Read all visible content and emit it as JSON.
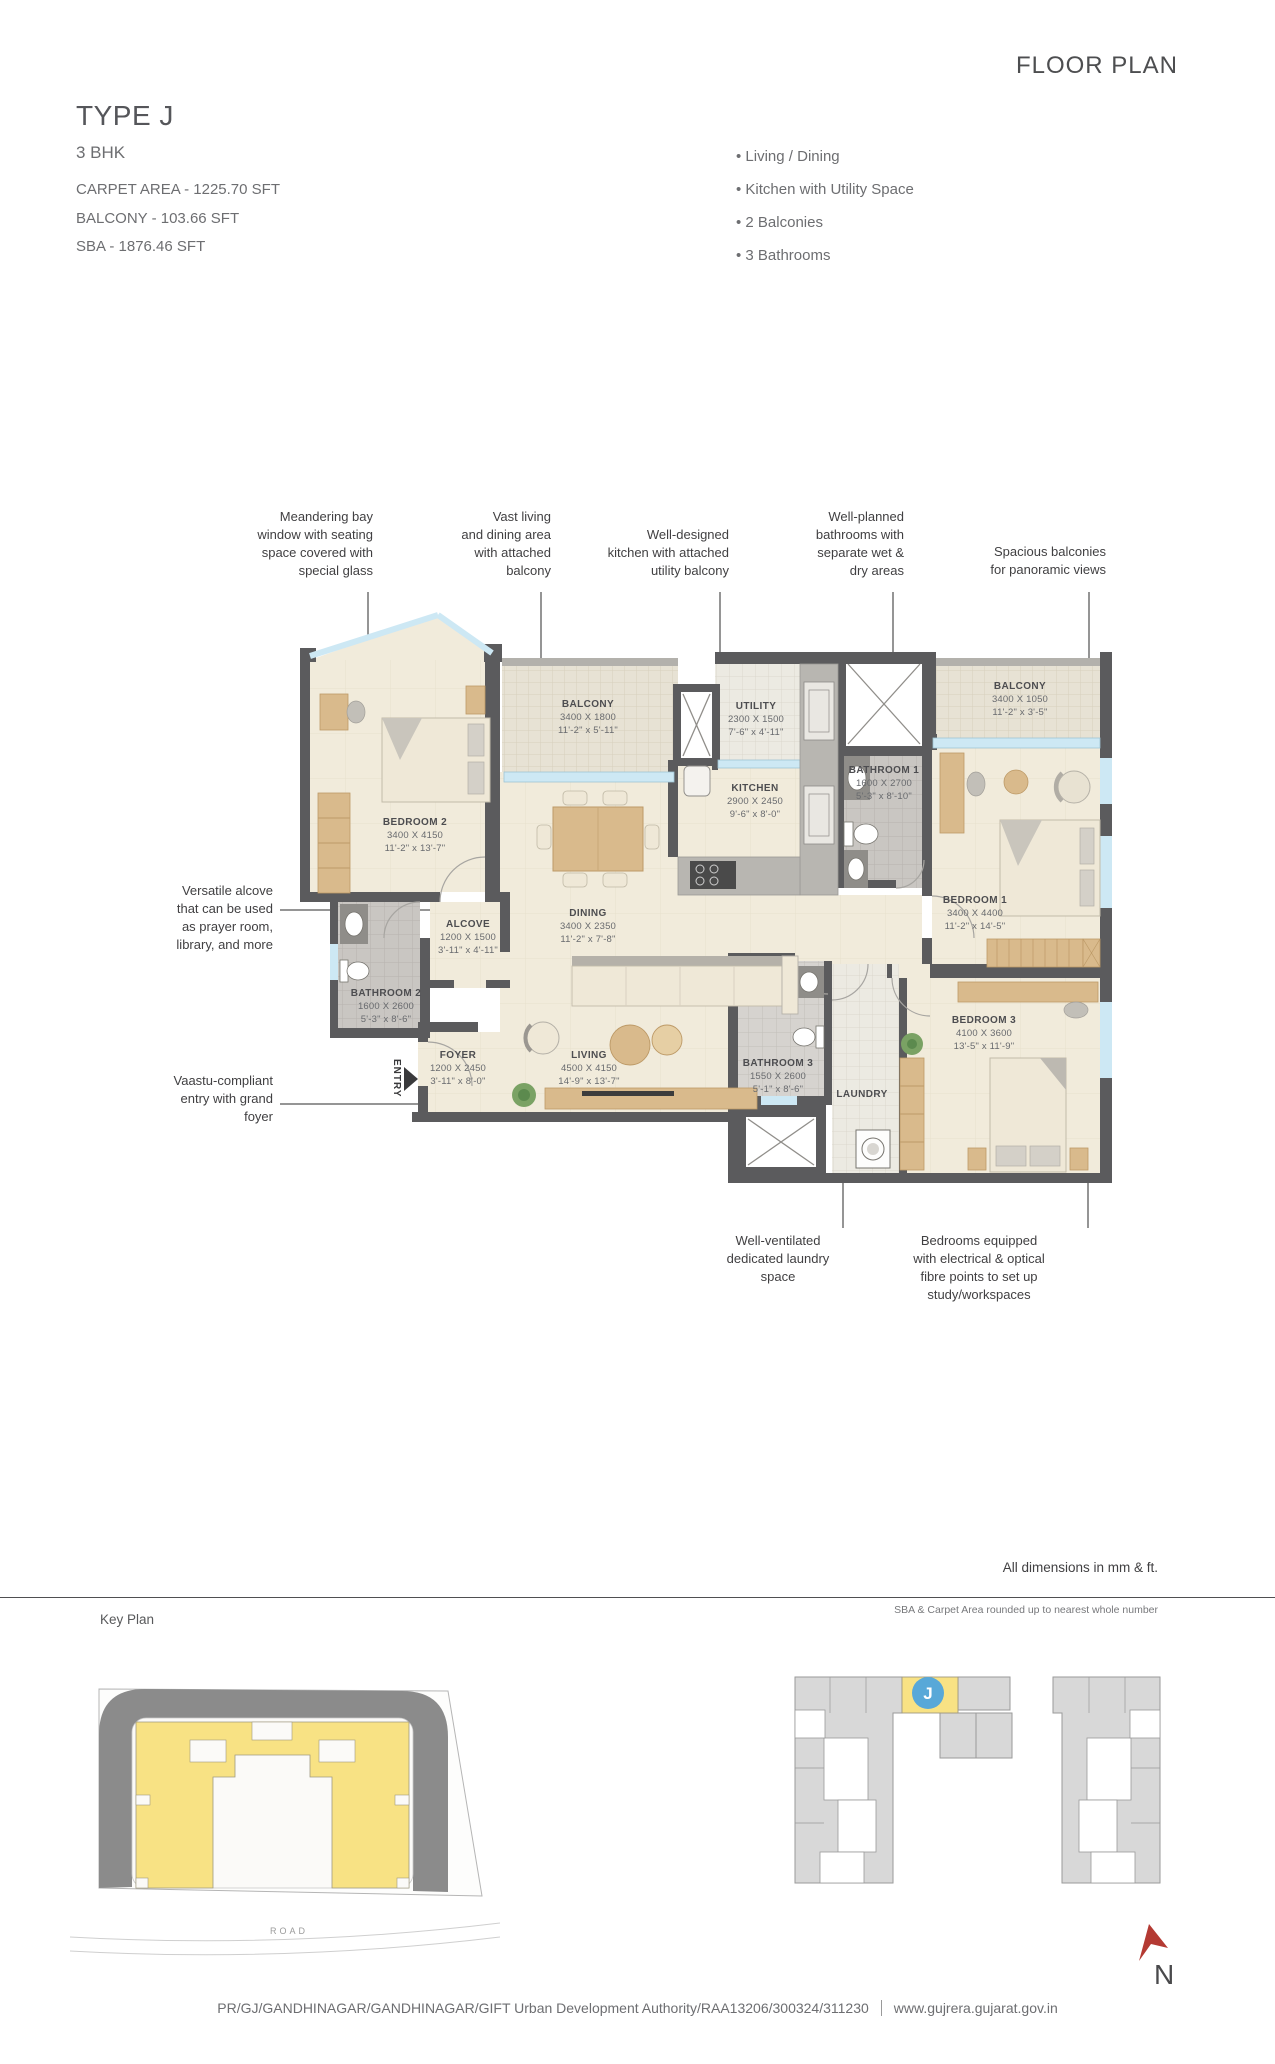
{
  "header": {
    "title": "FLOOR PLAN",
    "unit_type": "TYPE J",
    "bhk": "3 BHK",
    "carpet_area": "CARPET AREA - 1225.70 SFT",
    "balcony_area": "BALCONY - 103.66 SFT",
    "sba_area": "SBA - 1876.46 SFT"
  },
  "features": [
    "Living / Dining",
    "Kitchen with Utility Space",
    "2 Balconies",
    "3 Bathrooms"
  ],
  "annotations": {
    "bay_window": "Meandering bay\nwindow with seating\nspace covered with\nspecial glass",
    "living_dining": "Vast living\nand dining area\nwith attached\nbalcony",
    "kitchen": "Well-designed\nkitchen with attached\nutility balcony",
    "bathrooms": "Well-planned\nbathrooms with\nseparate wet &\ndry areas",
    "balconies": "Spacious balconies\nfor panoramic views",
    "alcove": "Versatile alcove\nthat can be used\nas prayer room,\nlibrary, and more",
    "entry": "Vaastu-compliant\nentry with grand\nfoyer",
    "laundry": "Well-ventilated\ndedicated laundry\nspace",
    "bedrooms": "Bedrooms equipped\nwith electrical & optical\nfibre points to set up\nstudy/workspaces"
  },
  "plan": {
    "entry_label": "ENTRY",
    "rooms": [
      {
        "key": "bedroom2",
        "name": "BEDROOM 2",
        "mm": "3400 X 4150",
        "ft": "11'-2\" x 13'-7\""
      },
      {
        "key": "balcony_l",
        "name": "BALCONY",
        "mm": "3400 X 1800",
        "ft": "11'-2\" x 5'-11\""
      },
      {
        "key": "utility",
        "name": "UTILITY",
        "mm": "2300 X 1500",
        "ft": "7'-6\" x 4'-11\""
      },
      {
        "key": "balcony_r",
        "name": "BALCONY",
        "mm": "3400 X 1050",
        "ft": "11'-2\" x 3'-5\""
      },
      {
        "key": "bathroom1",
        "name": "BATHROOM 1",
        "mm": "1600 X 2700",
        "ft": "5'-3\" x 8'-10\""
      },
      {
        "key": "kitchen",
        "name": "KITCHEN",
        "mm": "2900 X 2450",
        "ft": "9'-6\" x 8'-0\""
      },
      {
        "key": "bedroom1",
        "name": "BEDROOM 1",
        "mm": "3400 X 4400",
        "ft": "11'-2\" x 14'-5\""
      },
      {
        "key": "dining",
        "name": "DINING",
        "mm": "3400 X 2350",
        "ft": "11'-2\" x 7'-8\""
      },
      {
        "key": "alcove",
        "name": "ALCOVE",
        "mm": "1200 X 1500",
        "ft": "3'-11\" x 4'-11\""
      },
      {
        "key": "bathroom2",
        "name": "BATHROOM 2",
        "mm": "1600 X 2600",
        "ft": "5'-3\" x 8'-6\""
      },
      {
        "key": "foyer",
        "name": "FOYER",
        "mm": "1200 X 2450",
        "ft": "3'-11\" x 8'-0\""
      },
      {
        "key": "living",
        "name": "LIVING",
        "mm": "4500 X 4150",
        "ft": "14'-9\" x 13'-7\""
      },
      {
        "key": "bathroom3",
        "name": "BATHROOM 3",
        "mm": "1550 X 2600",
        "ft": "5'-1\" x 8'-6\""
      },
      {
        "key": "bedroom3",
        "name": "BEDROOM 3",
        "mm": "4100 X 3600",
        "ft": "13'-5\" x 11'-9\""
      },
      {
        "key": "laundry",
        "name": "LAUNDRY",
        "mm": "",
        "ft": ""
      }
    ]
  },
  "notes": {
    "dimensions": "All dimensions in mm & ft.",
    "rounding": "SBA & Carpet Area rounded up to nearest whole number",
    "keyplan_heading": "Key Plan"
  },
  "keyplan_site": {
    "road_label": "ROAD"
  },
  "keyplan_building": {
    "unit_label": "J"
  },
  "compass": {
    "label": "N"
  },
  "footer": {
    "rera": "PR/GJ/GANDHINAGAR/GANDHINAGAR/GIFT Urban Development Authority/RAA13206/300324/311230",
    "website": "www.gujrera.gujarat.gov.in"
  },
  "colors": {
    "wall": "#5b5b5d",
    "floor": "#f1ebdb",
    "glass": "#cde8f4",
    "highlight_yellow": "#f8e284",
    "unit_blue": "#58a8d8",
    "north_red": "#b43a33"
  }
}
